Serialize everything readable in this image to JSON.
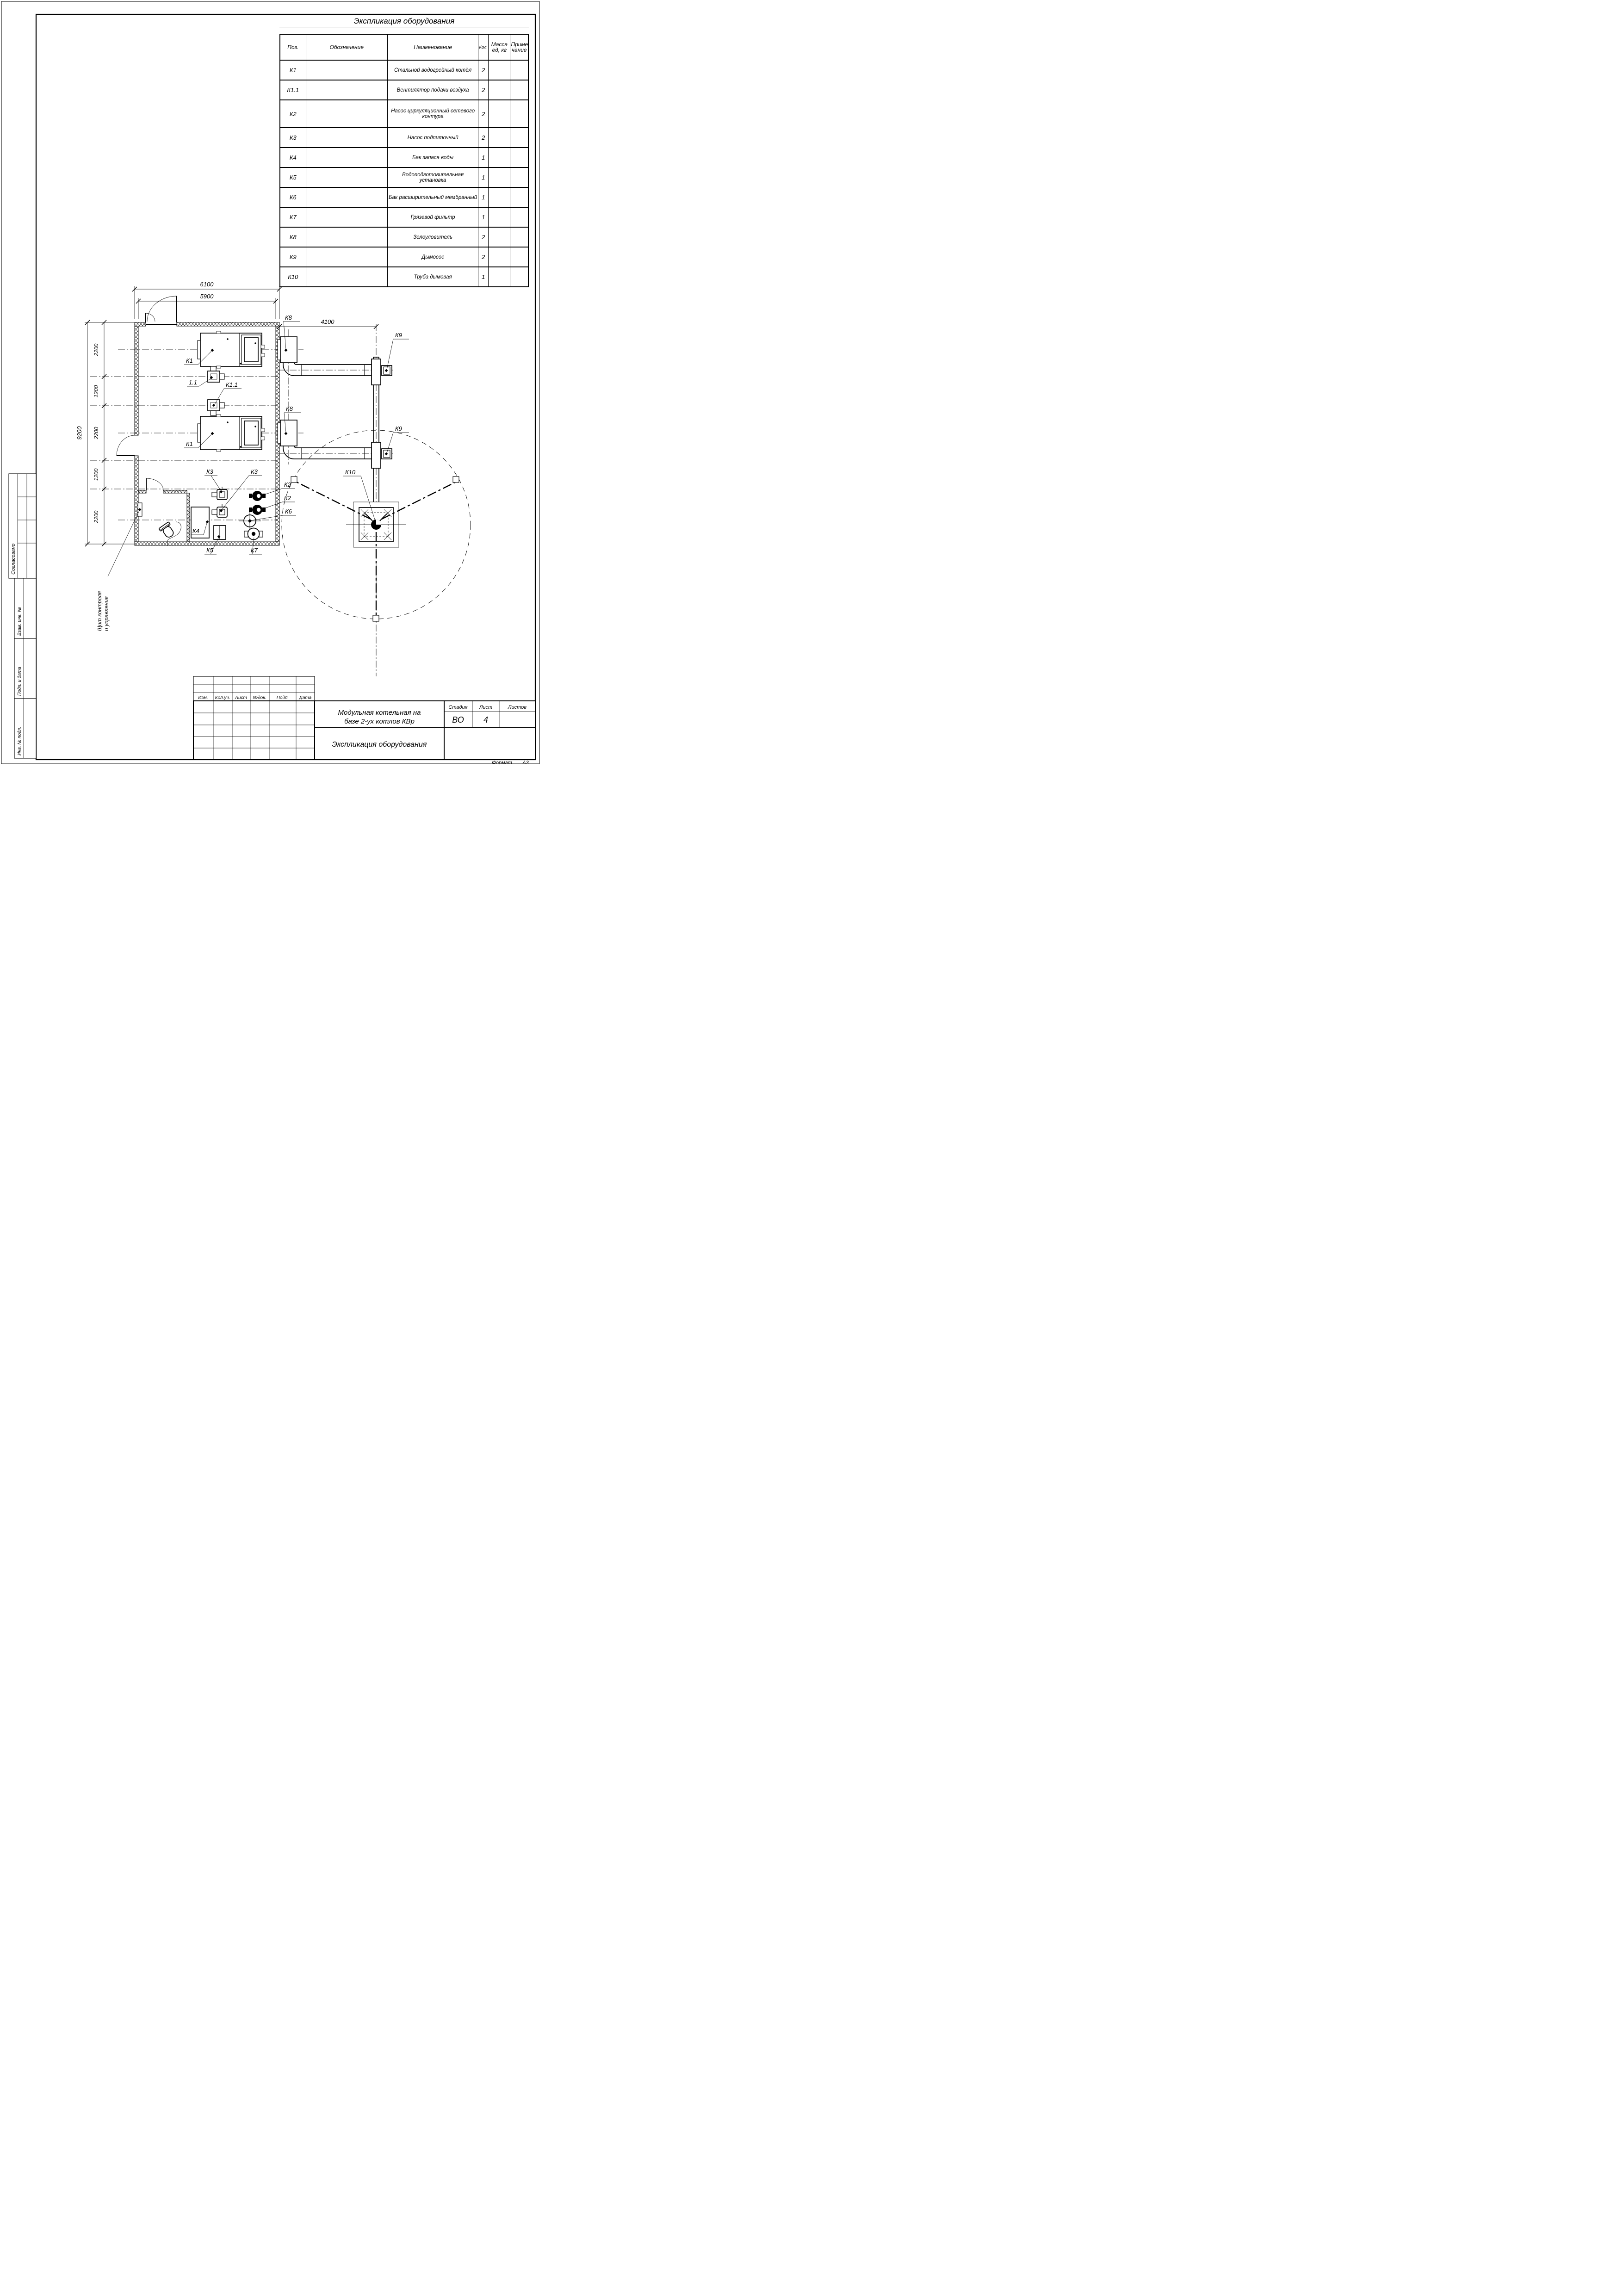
{
  "sheet": {
    "format_label": "Формат",
    "format_value": "А3"
  },
  "equipment_table": {
    "title": "Экспликация оборудования",
    "headers": {
      "pos": "Поз.",
      "designation": "Обозначение",
      "name": "Наименование",
      "qty": "Кол.",
      "mass_line1": "Масса",
      "mass_line2": "ед, кг",
      "note_line1": "Приме-",
      "note_line2": "чание"
    },
    "rows": [
      {
        "pos": "К1",
        "name": "Стальной водогрейный котёл",
        "qty": "2"
      },
      {
        "pos": "К1.1",
        "name": "Вентилятор подачи воздуха",
        "qty": "2"
      },
      {
        "pos": "К2",
        "name": "Насос циркуляционный сетевого контура",
        "qty": "2"
      },
      {
        "pos": "К3",
        "name": "Насос подпиточный",
        "qty": "2"
      },
      {
        "pos": "К4",
        "name": "Бак запаса воды",
        "qty": "1"
      },
      {
        "pos": "К5",
        "name": "Водоподготовительная установка",
        "qty": "1"
      },
      {
        "pos": "К6",
        "name": "Бак расширительный мембранный",
        "qty": "1"
      },
      {
        "pos": "К7",
        "name": "Грязевой фильтр",
        "qty": "1"
      },
      {
        "pos": "К8",
        "name": "Золоуловитель",
        "qty": "2"
      },
      {
        "pos": "К9",
        "name": "Дымосос",
        "qty": "2"
      },
      {
        "pos": "К10",
        "name": "Труба дымовая",
        "qty": "1"
      }
    ]
  },
  "title_block": {
    "rev_headers": [
      "Изм.",
      "Кол.уч.",
      "Лист",
      "№док.",
      "Подп.",
      "Дата"
    ],
    "project_title_line1": "Модульная котельная на",
    "project_title_line2": "базе 2-ух котлов КВр",
    "stage_label": "Стадия",
    "sheet_label": "Лист",
    "sheets_label": "Листов",
    "stage_value": "ВО",
    "sheet_value": "4",
    "sheets_value": "",
    "doc_name": "Экспликация оборудования"
  },
  "sidebar": {
    "agreed": "Согласовано",
    "replace_inv": "Взам. инв. №",
    "sign_date": "Подп. и дата",
    "inv_num": "Инв. № подл."
  },
  "plan": {
    "dims": {
      "width_total": "6100",
      "width_inner": "5900",
      "chimney_offset": "4100",
      "height_total": "9200",
      "seg_1": "2200",
      "seg_2": "1200",
      "seg_3": "2200",
      "seg_4": "1200",
      "seg_5": "2200"
    },
    "labels": {
      "boiler_top": "К1",
      "fan_top": "1.1",
      "fan_bottom": "К1.1",
      "boiler_bottom": "К1",
      "ash_top": "К8",
      "ash_bottom": "К8",
      "exhauster_top": "К9",
      "exhauster_bottom": "К9",
      "chimney": "К10",
      "pump_net_a": "К2",
      "pump_net_b": "К2",
      "exp_tank": "К6",
      "pump_makeup_a": "К3",
      "pump_makeup_b": "К3",
      "water_tank": "К4",
      "water_treatment": "К5",
      "mud_filter": "К7",
      "panel_line1": "Щит контроля",
      "panel_line2": "и управления"
    }
  }
}
